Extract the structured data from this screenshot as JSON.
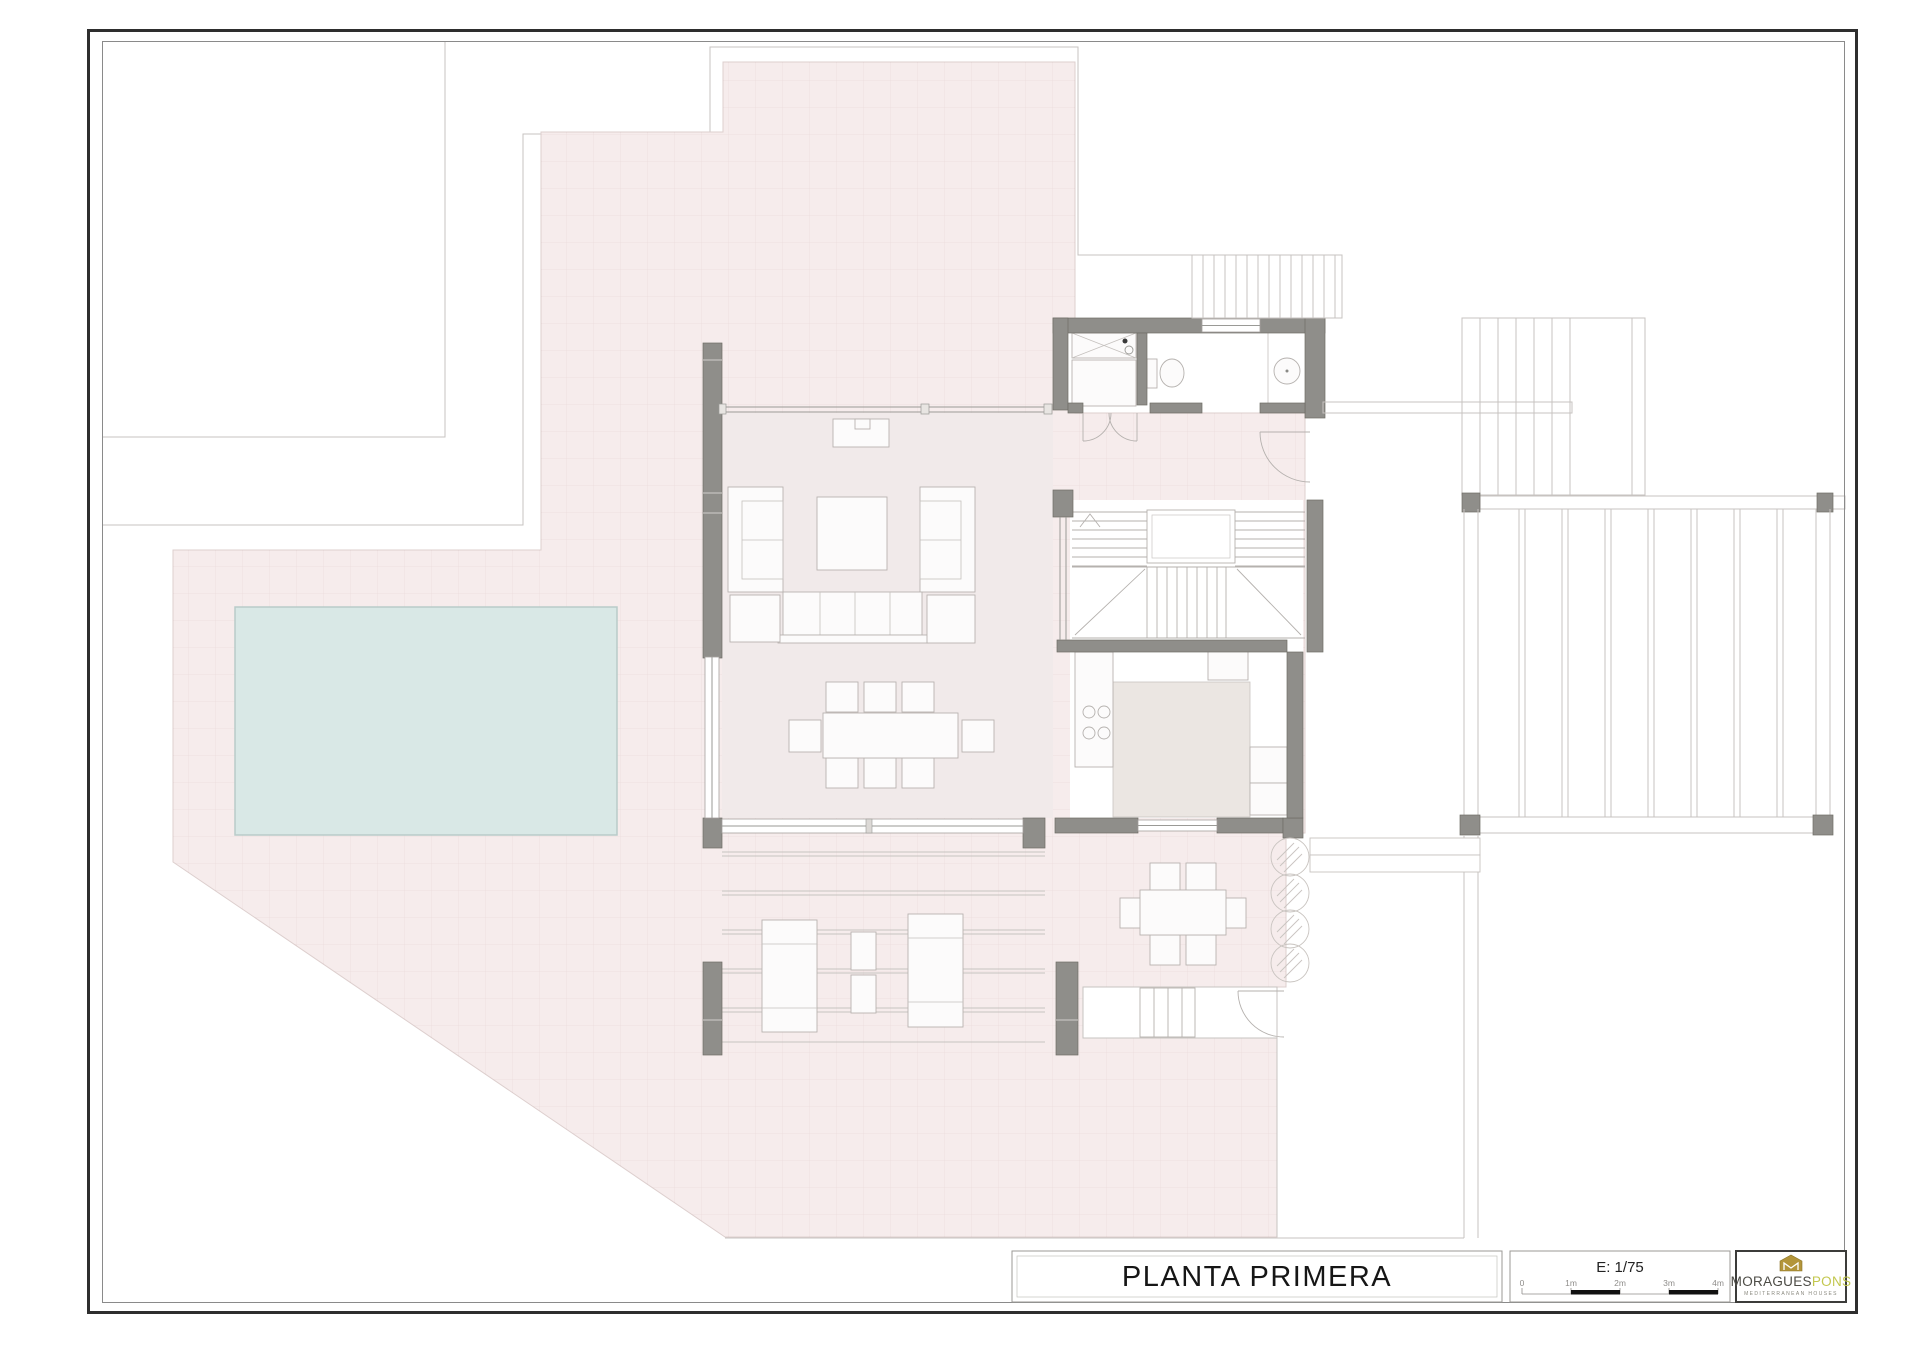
{
  "title_block": {
    "title": "PLANTA PRIMERA"
  },
  "scale_block": {
    "scale_label": "E: 1/75",
    "ticks": [
      "0",
      "1m",
      "2m",
      "3m",
      "4m"
    ]
  },
  "logo_block": {
    "brand_left": "MORAGUES",
    "brand_right": "PONS",
    "tagline": "MEDITERRANEAN HOUSES",
    "emblem_icon": "house-monogram-icon",
    "emblem_color": "#b3953a",
    "accent_color": "#c3c74e"
  },
  "plan": {
    "colors": {
      "terrace_pink": "#f6ecec",
      "interior_pink": "#f1eaea",
      "pool_blue": "#d9e8e6",
      "wall_gray": "#8f8e8a",
      "counter_gray": "#ebe6e2",
      "outline_gray": "#c7c3c0"
    }
  }
}
